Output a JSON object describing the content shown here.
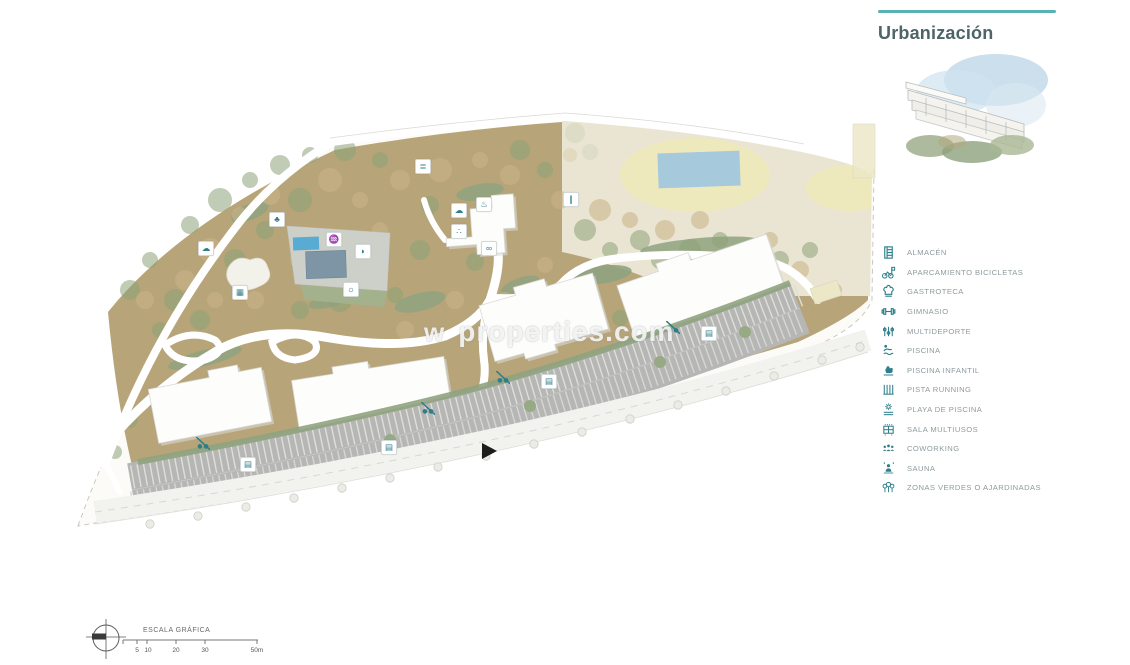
{
  "header": {
    "title": "Urbanización"
  },
  "colors": {
    "accent": "#59b1b2",
    "title_text": "#4d6468",
    "legend_icon": "#2e7e8a",
    "legend_text": "#8e9b9e",
    "landscape_tan": "#b7a478",
    "greenery": "#8fa37f",
    "sports_cream": "#eae5d2",
    "track_oval": "#eee9bd",
    "water_blue": "#a6c9dc",
    "pool_bright": "#58abd3",
    "parking_gray": "#b6b6b4",
    "building_white": "#fdfdfc"
  },
  "legend": {
    "items": [
      {
        "icon": "storage-icon",
        "label": "ALMACÉN"
      },
      {
        "icon": "bicycle-icon",
        "label": "APARCAMIENTO BICICLETAS"
      },
      {
        "icon": "chef-hat-icon",
        "label": "GASTROTECA"
      },
      {
        "icon": "dumbbell-icon",
        "label": "GIMNASIO"
      },
      {
        "icon": "multisport-icon",
        "label": "MULTIDEPORTE"
      },
      {
        "icon": "pool-icon",
        "label": "PISCINA"
      },
      {
        "icon": "duck-icon",
        "label": "PISCINA INFANTIL"
      },
      {
        "icon": "running-track-icon",
        "label": "PISTA RUNNING"
      },
      {
        "icon": "sun-deck-icon",
        "label": "PLAYA DE PISCINA"
      },
      {
        "icon": "multiuse-room-icon",
        "label": "SALA MULTIUSOS"
      },
      {
        "icon": "coworking-icon",
        "label": "COWORKING"
      },
      {
        "icon": "sauna-icon",
        "label": "SAUNA"
      },
      {
        "icon": "green-zones-icon",
        "label": "ZONAS VERDES O AJARDINADAS"
      }
    ]
  },
  "watermark": {
    "prefix": "w",
    "text": "properties.com"
  },
  "scale_bar": {
    "title": "ESCALA GRÁFICA",
    "ticks": [
      "5",
      "10",
      "20",
      "30",
      "50m"
    ]
  },
  "map": {
    "icons": [
      {
        "name": "multisport-marker",
        "glyph": "≣",
        "x": 422,
        "y": 165
      },
      {
        "name": "green-zone-marker",
        "glyph": "♣",
        "x": 276,
        "y": 218
      },
      {
        "name": "chef-hat-marker",
        "glyph": "☁",
        "x": 205,
        "y": 247
      },
      {
        "name": "multiuse-room-marker",
        "glyph": "▦",
        "x": 239,
        "y": 291
      },
      {
        "name": "pool-marker",
        "glyph": "♒",
        "x": 333,
        "y": 238
      },
      {
        "name": "infant-pool-marker",
        "glyph": "◗",
        "x": 362,
        "y": 250
      },
      {
        "name": "pool-beach-marker",
        "glyph": "☼",
        "x": 350,
        "y": 288
      },
      {
        "name": "sauna-marker",
        "glyph": "♨",
        "x": 483,
        "y": 203
      },
      {
        "name": "chef-hat-marker",
        "glyph": "☁",
        "x": 458,
        "y": 209
      },
      {
        "name": "coworking-marker",
        "glyph": "∴",
        "x": 458,
        "y": 230
      },
      {
        "name": "dumbbell-marker",
        "glyph": "∞",
        "x": 488,
        "y": 247
      },
      {
        "name": "running-marker",
        "glyph": "∥",
        "x": 570,
        "y": 198
      },
      {
        "name": "bike-marker",
        "bike": true,
        "x": 203,
        "y": 443
      },
      {
        "name": "storage-marker",
        "glyph": "▤",
        "x": 247,
        "y": 463
      },
      {
        "name": "bike-marker",
        "bike": true,
        "x": 428,
        "y": 408
      },
      {
        "name": "storage-marker",
        "glyph": "▤",
        "x": 388,
        "y": 446
      },
      {
        "name": "bike-marker",
        "bike": true,
        "x": 503,
        "y": 377
      },
      {
        "name": "storage-marker",
        "glyph": "▤",
        "x": 548,
        "y": 380
      },
      {
        "name": "bike-marker",
        "bike": true,
        "x": 673,
        "y": 327
      },
      {
        "name": "storage-marker",
        "glyph": "▤",
        "x": 708,
        "y": 332
      }
    ]
  }
}
